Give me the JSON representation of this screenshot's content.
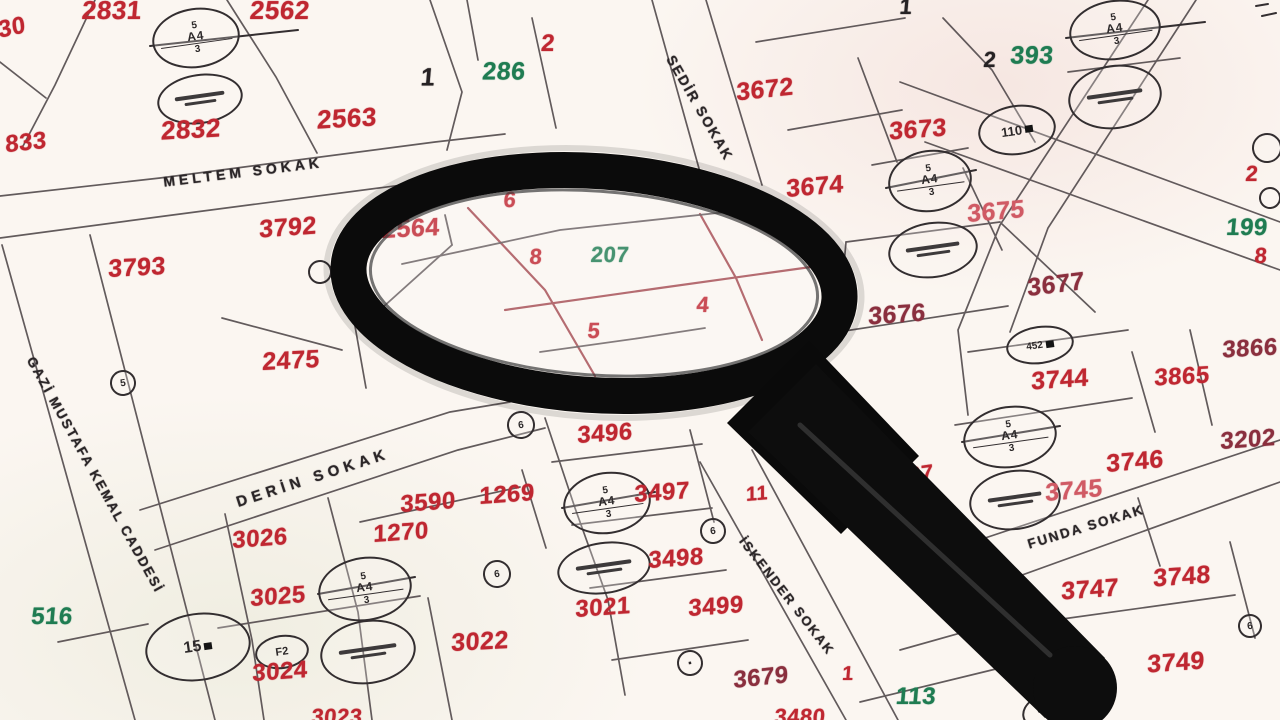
{
  "map_title": "cadastral parcel map",
  "palette": {
    "red": "#bf2731",
    "maroon": "#8a2f3e",
    "pink": "#d05a64",
    "green": "#1f7c52",
    "black": "#262224",
    "ink": "#2b2628"
  },
  "streets": [
    {
      "t": "MELTEM SOKAK",
      "x": 243,
      "y": 172,
      "r": -7,
      "s": 14,
      "ls": 4
    },
    {
      "t": "SEDİR SOKAK",
      "x": 700,
      "y": 108,
      "r": 60,
      "s": 14,
      "ls": 2
    },
    {
      "t": "GAZİ MUSTAFA KEMAL CADDESİ",
      "x": 95,
      "y": 475,
      "r": 61,
      "s": 13.5,
      "ls": 2
    },
    {
      "t": "DERİN SOKAK",
      "x": 313,
      "y": 478,
      "r": -18,
      "s": 15,
      "ls": 5
    },
    {
      "t": "İSKENDER SOKAK",
      "x": 787,
      "y": 596,
      "r": 52,
      "s": 13,
      "ls": 2
    },
    {
      "t": "FUNDA SOKAK",
      "x": 1086,
      "y": 527,
      "r": -17,
      "s": 13.5,
      "ls": 2
    }
  ],
  "parcels": [
    {
      "n": "2831",
      "x": 112,
      "y": 10,
      "c": "red",
      "s": 26,
      "r": 0
    },
    {
      "n": "2562",
      "x": 280,
      "y": 10,
      "c": "red",
      "s": 26,
      "r": 0
    },
    {
      "n": "30",
      "x": 12,
      "y": 28,
      "c": "red",
      "s": 24,
      "r": -12
    },
    {
      "n": "833",
      "x": 26,
      "y": 143,
      "c": "red",
      "s": 24,
      "r": -6
    },
    {
      "n": "2832",
      "x": 191,
      "y": 129,
      "c": "red",
      "s": 26,
      "r": -3
    },
    {
      "n": "2563",
      "x": 347,
      "y": 118,
      "c": "red",
      "s": 26,
      "r": -3
    },
    {
      "n": "3792",
      "x": 288,
      "y": 228,
      "c": "red",
      "s": 25,
      "r": -4
    },
    {
      "n": "3793",
      "x": 137,
      "y": 268,
      "c": "red",
      "s": 25,
      "r": -3
    },
    {
      "n": "2475",
      "x": 291,
      "y": 361,
      "c": "red",
      "s": 25,
      "r": -3
    },
    {
      "n": "1",
      "x": 428,
      "y": 78,
      "c": "black",
      "s": 25,
      "r": 0
    },
    {
      "n": "286",
      "x": 504,
      "y": 72,
      "c": "green",
      "s": 25,
      "r": 0
    },
    {
      "n": "2",
      "x": 548,
      "y": 44,
      "c": "red",
      "s": 24,
      "r": 0
    },
    {
      "n": "3672",
      "x": 765,
      "y": 90,
      "c": "red",
      "s": 25,
      "r": -6
    },
    {
      "n": "3673",
      "x": 918,
      "y": 130,
      "c": "red",
      "s": 25,
      "r": -4
    },
    {
      "n": "3674",
      "x": 815,
      "y": 187,
      "c": "red",
      "s": 25,
      "r": -5
    },
    {
      "n": "3675",
      "x": 996,
      "y": 212,
      "c": "pink",
      "s": 25,
      "r": -5
    },
    {
      "n": "1",
      "x": 906,
      "y": 7,
      "c": "black",
      "s": 22,
      "r": 0
    },
    {
      "n": "2",
      "x": 990,
      "y": 60,
      "c": "black",
      "s": 22,
      "r": 0
    },
    {
      "n": "393",
      "x": 1032,
      "y": 56,
      "c": "green",
      "s": 25,
      "r": 0
    },
    {
      "n": "2",
      "x": 1252,
      "y": 174,
      "c": "red",
      "s": 22,
      "r": 0
    },
    {
      "n": "199",
      "x": 1247,
      "y": 228,
      "c": "green",
      "s": 24,
      "r": 0
    },
    {
      "n": "8",
      "x": 1261,
      "y": 256,
      "c": "red",
      "s": 22,
      "r": 0
    },
    {
      "n": "3677",
      "x": 1056,
      "y": 285,
      "c": "maroon",
      "s": 25,
      "r": -7
    },
    {
      "n": "3676",
      "x": 897,
      "y": 315,
      "c": "maroon",
      "s": 25,
      "r": -4
    },
    {
      "n": "3866",
      "x": 1250,
      "y": 349,
      "c": "maroon",
      "s": 24,
      "r": -3
    },
    {
      "n": "3865",
      "x": 1182,
      "y": 377,
      "c": "red",
      "s": 24,
      "r": -3
    },
    {
      "n": "3744",
      "x": 1060,
      "y": 380,
      "c": "red",
      "s": 25,
      "r": -4
    },
    {
      "n": "3202",
      "x": 1248,
      "y": 440,
      "c": "maroon",
      "s": 24,
      "r": -4
    },
    {
      "n": "3746",
      "x": 1135,
      "y": 462,
      "c": "red",
      "s": 25,
      "r": -5
    },
    {
      "n": "3745",
      "x": 1074,
      "y": 491,
      "c": "pink",
      "s": 25,
      "r": -5
    },
    {
      "n": "27",
      "x": 921,
      "y": 474,
      "c": "red",
      "s": 22,
      "r": -8
    },
    {
      "n": "11",
      "x": 757,
      "y": 494,
      "c": "red",
      "s": 20,
      "r": -5
    },
    {
      "n": "3747",
      "x": 1090,
      "y": 590,
      "c": "red",
      "s": 25,
      "r": -4
    },
    {
      "n": "3748",
      "x": 1182,
      "y": 577,
      "c": "red",
      "s": 25,
      "r": -4
    },
    {
      "n": "3749",
      "x": 1176,
      "y": 663,
      "c": "red",
      "s": 25,
      "r": -4
    },
    {
      "n": "113",
      "x": 916,
      "y": 697,
      "c": "green",
      "s": 24,
      "r": 0
    },
    {
      "n": "1",
      "x": 848,
      "y": 674,
      "c": "red",
      "s": 20,
      "r": 0
    },
    {
      "n": "3679",
      "x": 761,
      "y": 678,
      "c": "maroon",
      "s": 24,
      "r": -6
    },
    {
      "n": "3496",
      "x": 605,
      "y": 434,
      "c": "red",
      "s": 24,
      "r": -4
    },
    {
      "n": "3497",
      "x": 662,
      "y": 493,
      "c": "red",
      "s": 24,
      "r": -4
    },
    {
      "n": "3498",
      "x": 676,
      "y": 559,
      "c": "red",
      "s": 24,
      "r": -4
    },
    {
      "n": "3499",
      "x": 716,
      "y": 607,
      "c": "red",
      "s": 24,
      "r": -4
    },
    {
      "n": "3021",
      "x": 603,
      "y": 608,
      "c": "red",
      "s": 24,
      "r": -4
    },
    {
      "n": "3022",
      "x": 480,
      "y": 642,
      "c": "red",
      "s": 25,
      "r": -3
    },
    {
      "n": "1269",
      "x": 507,
      "y": 495,
      "c": "red",
      "s": 24,
      "r": -4
    },
    {
      "n": "3590",
      "x": 428,
      "y": 503,
      "c": "red",
      "s": 24,
      "r": -4
    },
    {
      "n": "1270",
      "x": 401,
      "y": 533,
      "c": "red",
      "s": 24,
      "r": -4
    },
    {
      "n": "3026",
      "x": 260,
      "y": 539,
      "c": "red",
      "s": 24,
      "r": -4
    },
    {
      "n": "3025",
      "x": 278,
      "y": 597,
      "c": "red",
      "s": 24,
      "r": -4
    },
    {
      "n": "3024",
      "x": 280,
      "y": 672,
      "c": "red",
      "s": 24,
      "r": -4
    },
    {
      "n": "516",
      "x": 52,
      "y": 617,
      "c": "green",
      "s": 24,
      "r": 0
    },
    {
      "n": "6",
      "x": 510,
      "y": 200,
      "c": "red",
      "s": 22,
      "r": 0
    },
    {
      "n": "2564",
      "x": 411,
      "y": 229,
      "c": "red",
      "s": 25,
      "r": -3
    },
    {
      "n": "8",
      "x": 536,
      "y": 257,
      "c": "red",
      "s": 22,
      "r": 0
    },
    {
      "n": "207",
      "x": 610,
      "y": 255,
      "c": "green",
      "s": 22,
      "r": 0
    },
    {
      "n": "4",
      "x": 703,
      "y": 305,
      "c": "red",
      "s": 22,
      "r": 0
    },
    {
      "n": "5",
      "x": 594,
      "y": 331,
      "c": "red",
      "s": 22,
      "r": 0
    },
    {
      "n": "3023",
      "x": 337,
      "y": 717,
      "c": "red",
      "s": 22,
      "r": 0
    },
    {
      "n": "3480",
      "x": 800,
      "y": 717,
      "c": "red",
      "s": 22,
      "r": 0
    }
  ],
  "markers": {
    "fractions": [
      {
        "x": 196,
        "y": 38,
        "rx": 44,
        "ry": 30,
        "top": "5",
        "mid": "A4",
        "bot": "3"
      },
      {
        "x": 1115,
        "y": 30,
        "rx": 46,
        "ry": 30,
        "top": "5",
        "mid": "A4",
        "bot": "3"
      },
      {
        "x": 930,
        "y": 181,
        "rx": 42,
        "ry": 31,
        "top": "5",
        "mid": "A4",
        "bot": "3"
      },
      {
        "x": 1010,
        "y": 437,
        "rx": 47,
        "ry": 31,
        "top": "5",
        "mid": "A4",
        "bot": "3"
      },
      {
        "x": 607,
        "y": 503,
        "rx": 44,
        "ry": 31,
        "top": "5",
        "mid": "A4",
        "bot": "3"
      },
      {
        "x": 365,
        "y": 589,
        "rx": 47,
        "ry": 32,
        "top": "5",
        "mid": "A4",
        "bot": "3"
      }
    ],
    "stamps": [
      {
        "x": 200,
        "y": 99,
        "rx": 43,
        "ry": 25
      },
      {
        "x": 1115,
        "y": 97,
        "rx": 47,
        "ry": 32
      },
      {
        "x": 933,
        "y": 250,
        "rx": 45,
        "ry": 28
      },
      {
        "x": 1015,
        "y": 500,
        "rx": 46,
        "ry": 30
      },
      {
        "x": 604,
        "y": 568,
        "rx": 47,
        "ry": 26
      },
      {
        "x": 368,
        "y": 652,
        "rx": 48,
        "ry": 32
      },
      {
        "x": 1060,
        "y": 711,
        "rx": 38,
        "ry": 22
      }
    ],
    "tags": [
      {
        "x": 1017,
        "y": 130,
        "rx": 39,
        "ry": 25,
        "text": "110",
        "sq": true,
        "fs": 13
      },
      {
        "x": 198,
        "y": 647,
        "rx": 53,
        "ry": 34,
        "text": "15",
        "sq": true,
        "fs": 16
      },
      {
        "x": 282,
        "y": 652,
        "rx": 27,
        "ry": 17,
        "text": "F2",
        "sq": false,
        "fs": 11
      },
      {
        "x": 1040,
        "y": 345,
        "rx": 34,
        "ry": 19,
        "text": "452",
        "sq": true,
        "fs": 10
      }
    ],
    "dots": [
      {
        "x": 123,
        "y": 383,
        "r": 13,
        "g": "5"
      },
      {
        "x": 320,
        "y": 272,
        "r": 12,
        "g": ""
      },
      {
        "x": 521,
        "y": 425,
        "r": 14,
        "g": "6"
      },
      {
        "x": 497,
        "y": 574,
        "r": 14,
        "g": "6"
      },
      {
        "x": 713,
        "y": 531,
        "r": 13,
        "g": "6"
      },
      {
        "x": 690,
        "y": 663,
        "r": 13,
        "g": "▪"
      },
      {
        "x": 1250,
        "y": 626,
        "r": 12,
        "g": "6"
      },
      {
        "x": 1267,
        "y": 148,
        "r": 15,
        "g": ""
      },
      {
        "x": 1270,
        "y": 198,
        "r": 11,
        "g": ""
      }
    ]
  }
}
